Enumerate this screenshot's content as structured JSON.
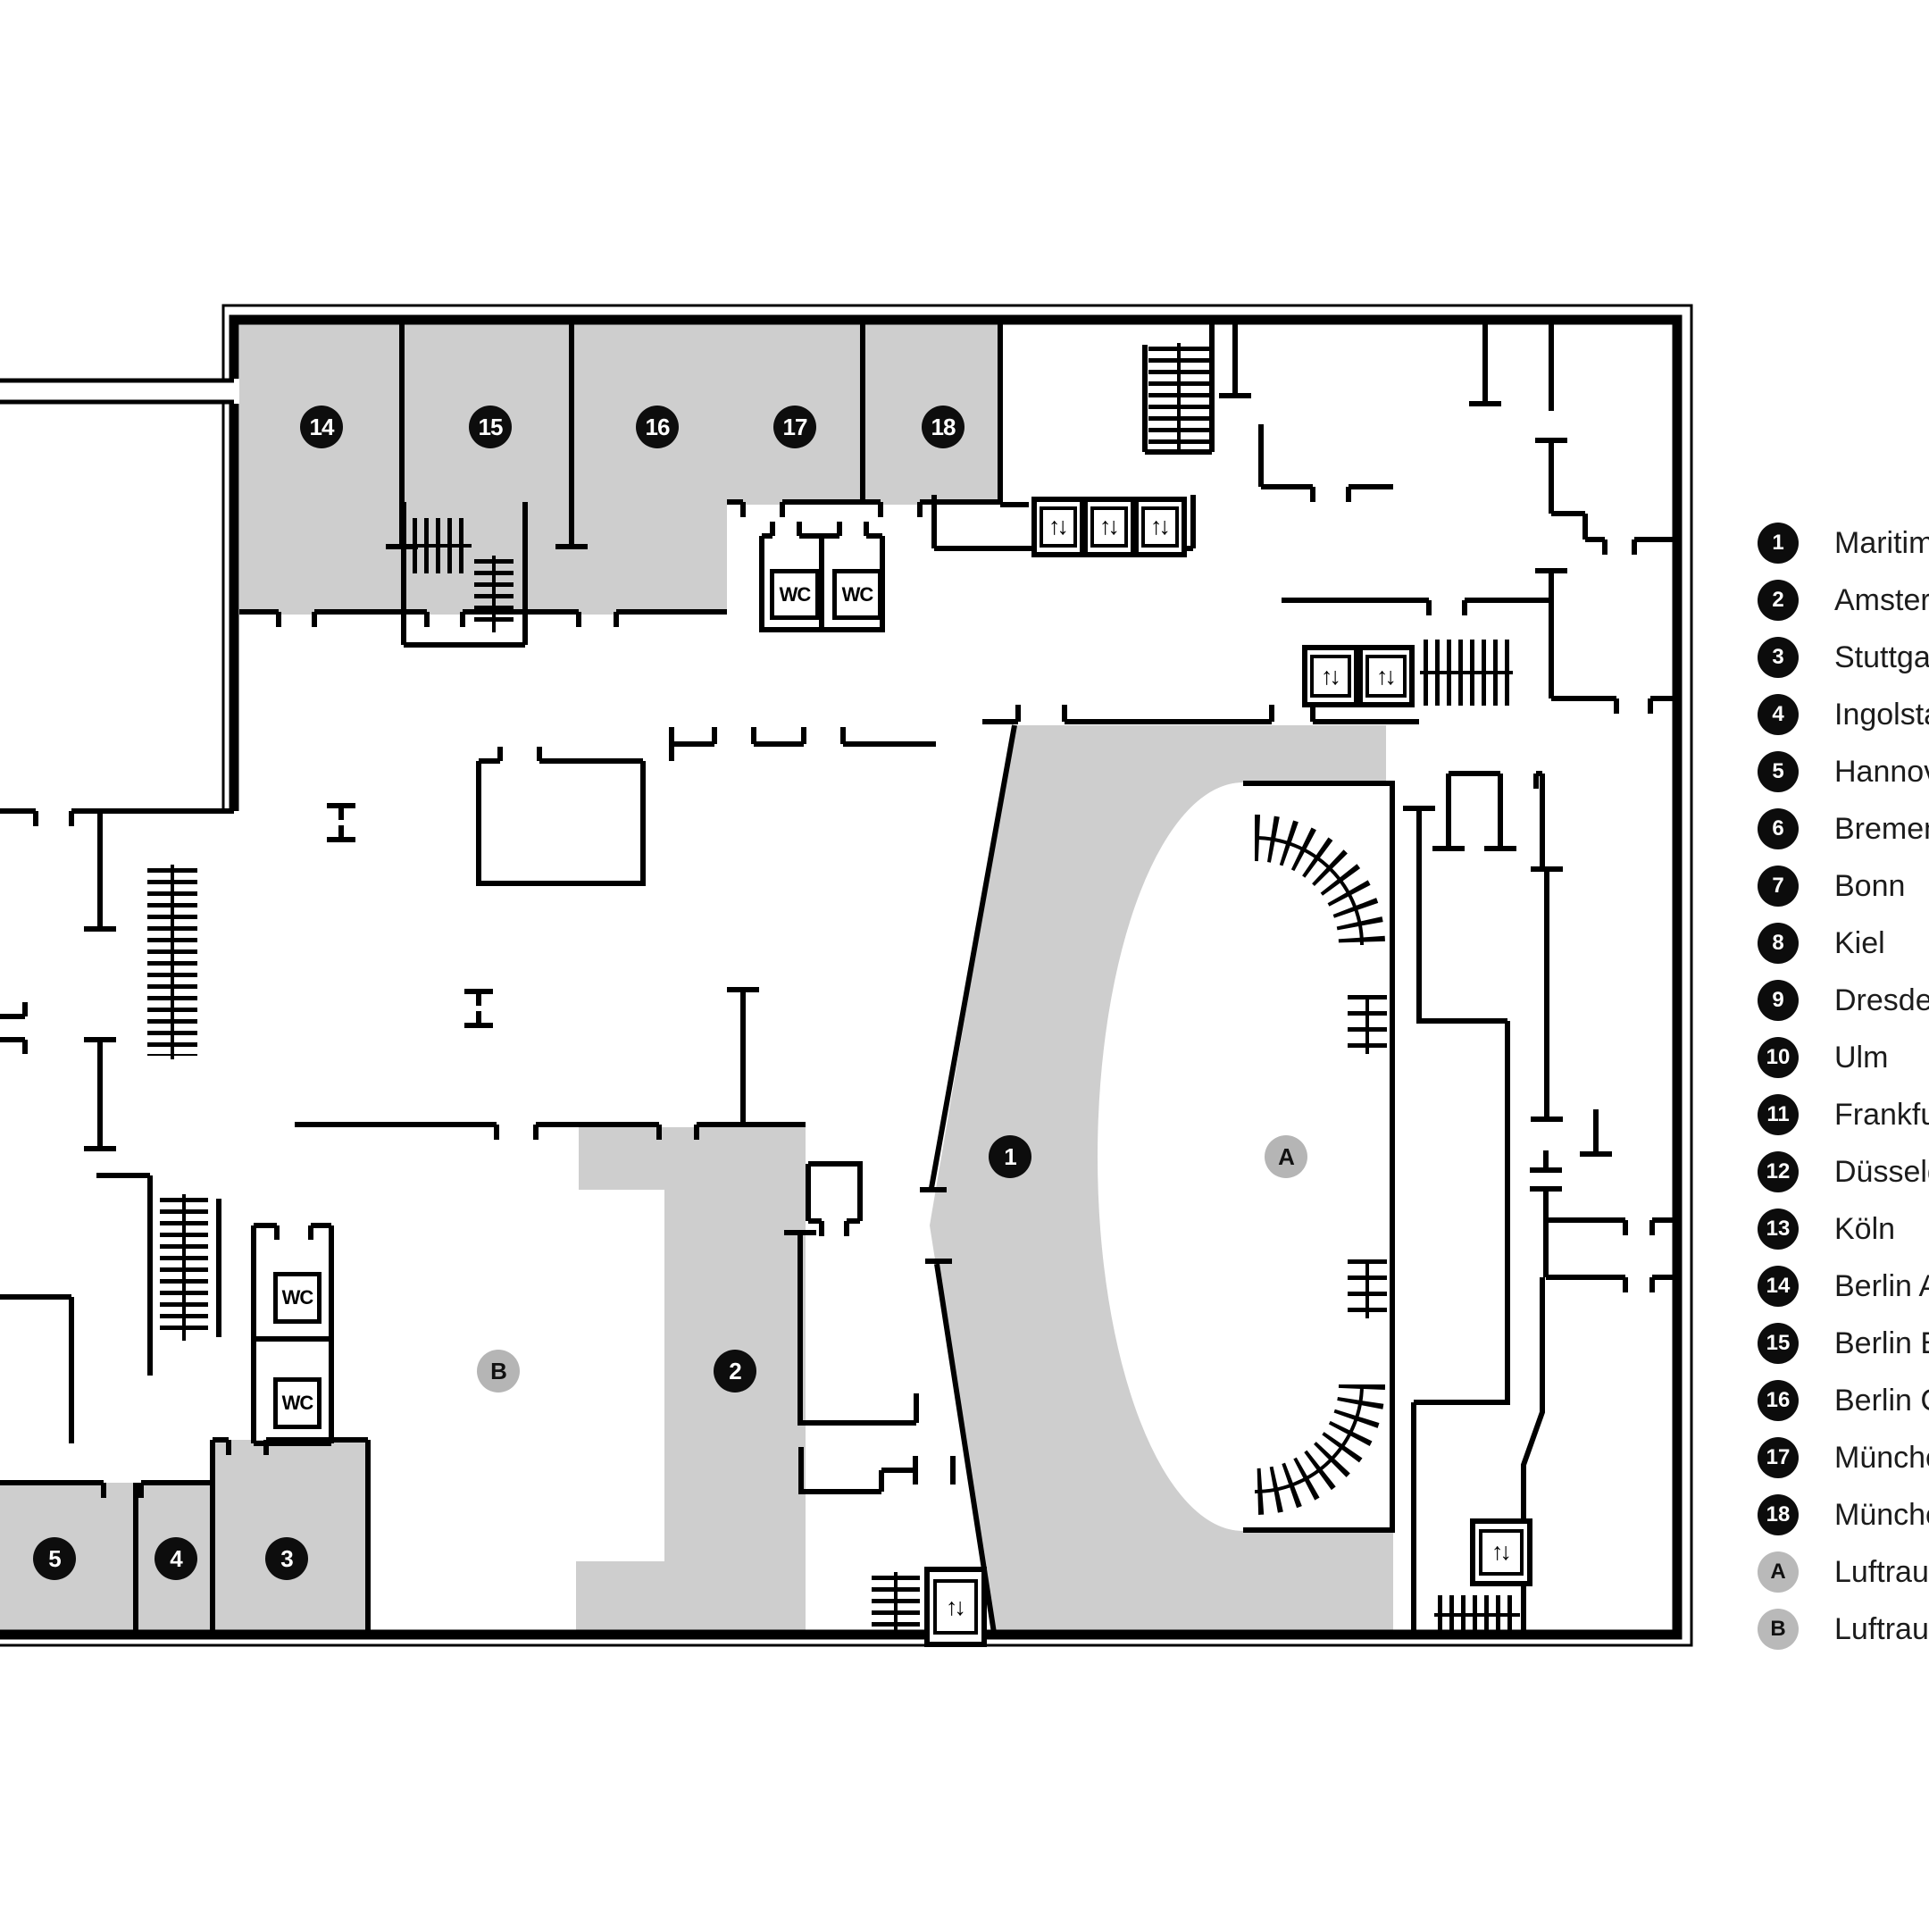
{
  "legend": {
    "items": [
      {
        "num": "1",
        "label": "Maritim E",
        "variant": "dark"
      },
      {
        "num": "2",
        "label": "Amsterda",
        "variant": "dark"
      },
      {
        "num": "3",
        "label": "Stuttgart",
        "variant": "dark"
      },
      {
        "num": "4",
        "label": "Ingolstad",
        "variant": "dark"
      },
      {
        "num": "5",
        "label": "Hannove",
        "variant": "dark"
      },
      {
        "num": "6",
        "label": "Bremen",
        "variant": "dark"
      },
      {
        "num": "7",
        "label": "Bonn",
        "variant": "dark"
      },
      {
        "num": "8",
        "label": "Kiel",
        "variant": "dark"
      },
      {
        "num": "9",
        "label": "Dresden",
        "variant": "dark"
      },
      {
        "num": "10",
        "label": "Ulm",
        "variant": "dark"
      },
      {
        "num": "11",
        "label": "Frankfurt",
        "variant": "dark"
      },
      {
        "num": "12",
        "label": "Düsseldo",
        "variant": "dark"
      },
      {
        "num": "13",
        "label": "Köln",
        "variant": "dark"
      },
      {
        "num": "14",
        "label": "Berlin A",
        "variant": "dark"
      },
      {
        "num": "15",
        "label": "Berlin B",
        "variant": "dark"
      },
      {
        "num": "16",
        "label": "Berlin C",
        "variant": "dark"
      },
      {
        "num": "17",
        "label": "München",
        "variant": "dark"
      },
      {
        "num": "18",
        "label": "München",
        "variant": "dark"
      },
      {
        "num": "A",
        "label": "Luftraum,",
        "variant": "gray"
      },
      {
        "num": "B",
        "label": "Luftraum,",
        "variant": "gray"
      }
    ]
  },
  "plan": {
    "badges": [
      {
        "id": "14",
        "label": "14",
        "variant": "dark"
      },
      {
        "id": "15",
        "label": "15",
        "variant": "dark"
      },
      {
        "id": "16",
        "label": "16",
        "variant": "dark"
      },
      {
        "id": "17",
        "label": "17",
        "variant": "dark"
      },
      {
        "id": "18",
        "label": "18",
        "variant": "dark"
      },
      {
        "id": "1",
        "label": "1",
        "variant": "dark"
      },
      {
        "id": "A",
        "label": "A",
        "variant": "gray"
      },
      {
        "id": "B",
        "label": "B",
        "variant": "gray"
      },
      {
        "id": "2",
        "label": "2",
        "variant": "dark"
      },
      {
        "id": "3",
        "label": "3",
        "variant": "dark"
      },
      {
        "id": "4",
        "label": "4",
        "variant": "dark"
      },
      {
        "id": "5",
        "label": "5",
        "variant": "dark"
      }
    ],
    "wc_label": "WC",
    "elevator_glyph": "↑↓",
    "colors": {
      "room_fill": "#cecece",
      "wall": "#000000",
      "badge_dark": "#0d0d0d",
      "badge_gray": "#b5b5b5"
    }
  }
}
